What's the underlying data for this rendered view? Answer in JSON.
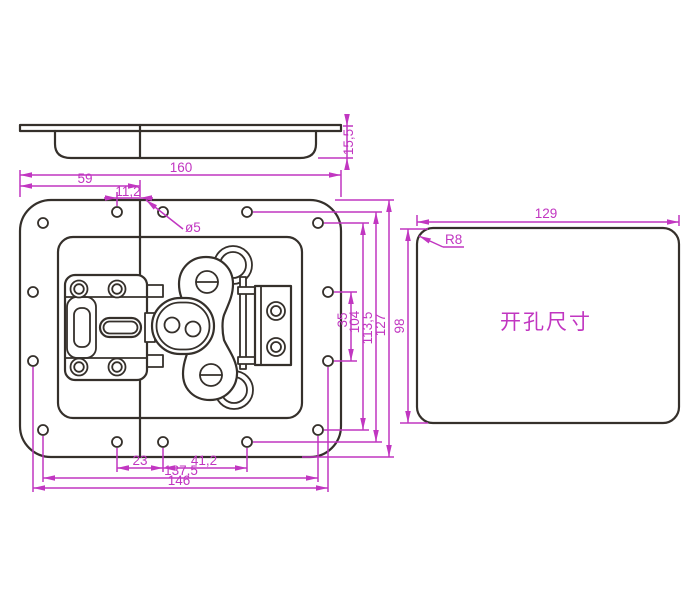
{
  "drawing": {
    "type": "engineering-drawing",
    "colors": {
      "outline": "#35302b",
      "dimension": "#c136c1",
      "background": "#ffffff"
    },
    "dims": {
      "profile_height": "15,5",
      "overall_width": "160",
      "center_offset": "59",
      "hole_center_offset": "11,2",
      "hole_diameter": "ø5",
      "side_hole_pitch_v": "35",
      "corner_hole_pitch_v": "104",
      "hole_row_pitch_v": "113,5",
      "overall_height": "127",
      "bottom_pitch_a": "23",
      "bottom_pitch_b": "41,2",
      "corner_hole_pitch_h": "137,5",
      "side_hole_pitch_h": "146"
    },
    "cutout": {
      "width": "129",
      "corner_radius": "R8",
      "height": "98",
      "label": "开孔尺寸"
    }
  }
}
